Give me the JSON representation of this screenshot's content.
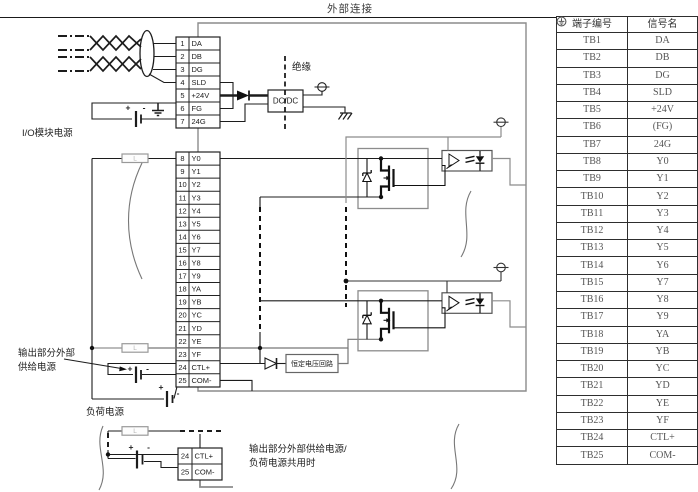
{
  "title": "外部连接",
  "table": {
    "headers": [
      "端子编号",
      "信号名"
    ],
    "rows": [
      {
        "terminal": "TB1",
        "signal": "DA"
      },
      {
        "terminal": "TB2",
        "signal": "DB"
      },
      {
        "terminal": "TB3",
        "signal": "DG"
      },
      {
        "terminal": "TB4",
        "signal": "SLD"
      },
      {
        "terminal": "TB5",
        "signal": "+24V"
      },
      {
        "terminal": "TB6",
        "signal": "(FG)",
        "icon": "protective-earth"
      },
      {
        "terminal": "TB7",
        "signal": "24G"
      },
      {
        "terminal": "TB8",
        "signal": "Y0"
      },
      {
        "terminal": "TB9",
        "signal": "Y1"
      },
      {
        "terminal": "TB10",
        "signal": "Y2"
      },
      {
        "terminal": "TB11",
        "signal": "Y3"
      },
      {
        "terminal": "TB12",
        "signal": "Y4"
      },
      {
        "terminal": "TB13",
        "signal": "Y5"
      },
      {
        "terminal": "TB14",
        "signal": "Y6"
      },
      {
        "terminal": "TB15",
        "signal": "Y7"
      },
      {
        "terminal": "TB16",
        "signal": "Y8"
      },
      {
        "terminal": "TB17",
        "signal": "Y9"
      },
      {
        "terminal": "TB18",
        "signal": "YA"
      },
      {
        "terminal": "TB19",
        "signal": "YB"
      },
      {
        "terminal": "TB20",
        "signal": "YC"
      },
      {
        "terminal": "TB21",
        "signal": "YD"
      },
      {
        "terminal": "TB22",
        "signal": "YE"
      },
      {
        "terminal": "TB23",
        "signal": "YF"
      },
      {
        "terminal": "TB24",
        "signal": "CTL+"
      },
      {
        "terminal": "TB25",
        "signal": "COM-"
      }
    ]
  },
  "diagram": {
    "terminal_block_upper": {
      "rows": [
        {
          "num": "1",
          "label": "DA"
        },
        {
          "num": "2",
          "label": "DB"
        },
        {
          "num": "3",
          "label": "DG"
        },
        {
          "num": "4",
          "label": "SLD"
        },
        {
          "num": "5",
          "label": "+24V"
        },
        {
          "num": "6",
          "label": "FG"
        },
        {
          "num": "7",
          "label": "24G"
        }
      ]
    },
    "terminal_block_lower": {
      "rows": [
        {
          "num": "8",
          "label": "Y0"
        },
        {
          "num": "9",
          "label": "Y1"
        },
        {
          "num": "10",
          "label": "Y2"
        },
        {
          "num": "11",
          "label": "Y3"
        },
        {
          "num": "12",
          "label": "Y4"
        },
        {
          "num": "13",
          "label": "Y5"
        },
        {
          "num": "14",
          "label": "Y6"
        },
        {
          "num": "15",
          "label": "Y7"
        },
        {
          "num": "16",
          "label": "Y8"
        },
        {
          "num": "17",
          "label": "Y9"
        },
        {
          "num": "18",
          "label": "YA"
        },
        {
          "num": "19",
          "label": "YB"
        },
        {
          "num": "20",
          "label": "YC"
        },
        {
          "num": "21",
          "label": "YD"
        },
        {
          "num": "22",
          "label": "YE"
        },
        {
          "num": "23",
          "label": "YF"
        },
        {
          "num": "24",
          "label": "CTL+"
        },
        {
          "num": "25",
          "label": "COM-"
        }
      ]
    },
    "terminal_block_shared": {
      "rows": [
        {
          "num": "24",
          "label": "CTL+"
        },
        {
          "num": "25",
          "label": "COM-"
        }
      ]
    },
    "labels": {
      "io_module_power": "I/O模块电源",
      "insulation": "绝缘",
      "dcdc": "DC/DC",
      "constant_voltage_circuit": "恒定电压回路",
      "output_external_supply_line1": "输出部分外部",
      "output_external_supply_line2": "供给电源",
      "load_power": "负荷电源",
      "shared_note_line1": "输出部分外部供给电源/",
      "shared_note_line2": "负荷电源共用时",
      "load_mark": "L",
      "plus": "+",
      "minus": "-"
    }
  },
  "colors": {
    "wire": "#1c1c1c",
    "wire_gray": "#8c8c8c",
    "box_gray": "#8c8c8c",
    "text": "#333333"
  }
}
